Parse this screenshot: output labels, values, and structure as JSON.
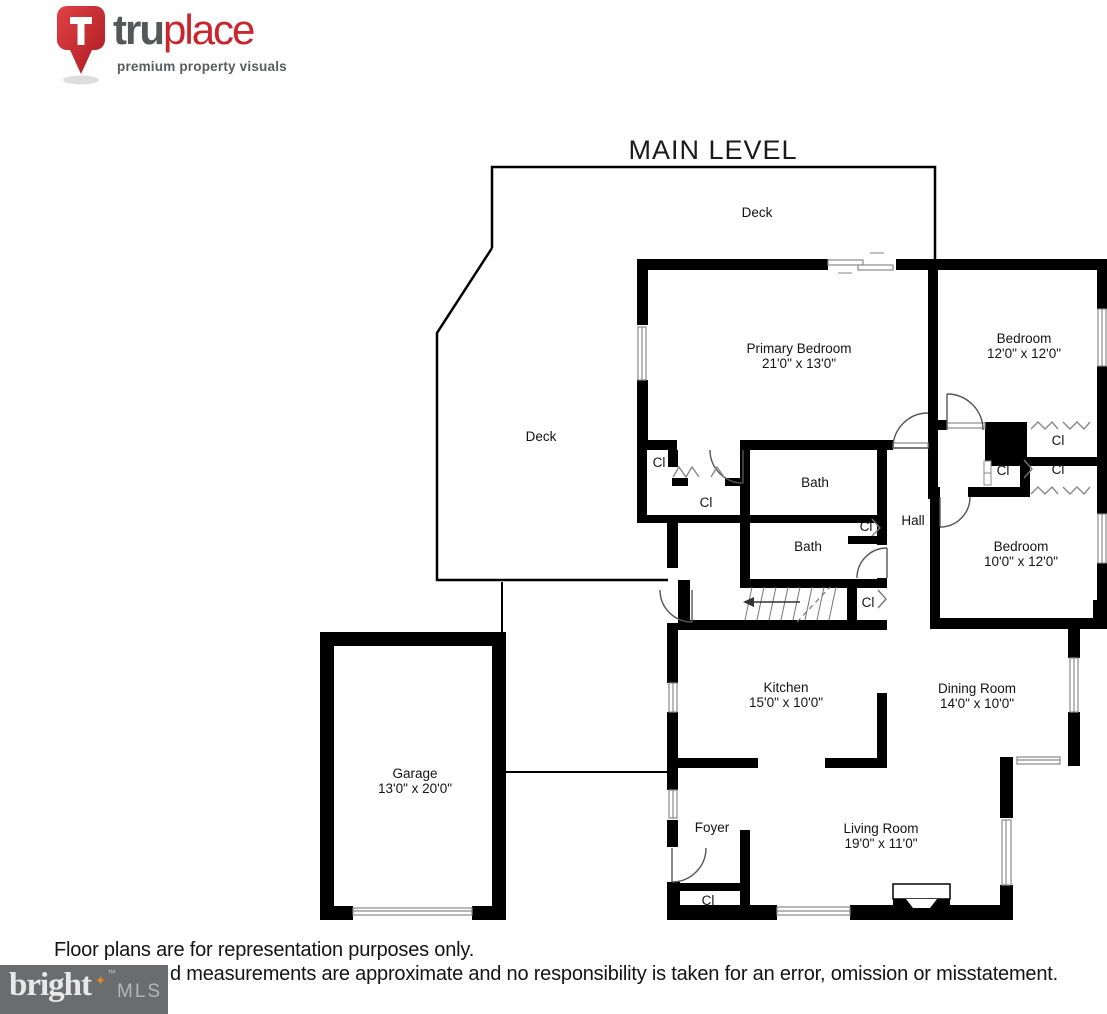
{
  "header": {
    "brand_prefix": "tru",
    "brand_suffix": "place",
    "tagline": "premium property visuals"
  },
  "title": "MAIN LEVEL",
  "plan": {
    "closet_label": "Cl",
    "rooms": [
      {
        "id": "deck-top",
        "name": "Deck",
        "dims": ""
      },
      {
        "id": "deck-left",
        "name": "Deck",
        "dims": ""
      },
      {
        "id": "primary-bedroom",
        "name": "Primary Bedroom",
        "dims": "21'0\" x 13'0\""
      },
      {
        "id": "bedroom-1",
        "name": "Bedroom",
        "dims": "12'0\" x 12'0\""
      },
      {
        "id": "bedroom-2",
        "name": "Bedroom",
        "dims": "10'0\" x 12'0\""
      },
      {
        "id": "bath-1",
        "name": "Bath",
        "dims": ""
      },
      {
        "id": "bath-2",
        "name": "Bath",
        "dims": ""
      },
      {
        "id": "hall",
        "name": "Hall",
        "dims": ""
      },
      {
        "id": "kitchen",
        "name": "Kitchen",
        "dims": "15'0\" x 10'0\""
      },
      {
        "id": "dining-room",
        "name": "Dining Room",
        "dims": "14'0\" x 10'0\""
      },
      {
        "id": "garage",
        "name": "Garage",
        "dims": "13'0\" x 20'0\""
      },
      {
        "id": "foyer",
        "name": "Foyer",
        "dims": ""
      },
      {
        "id": "living-room",
        "name": "Living Room",
        "dims": "19'0\" x 11'0\""
      }
    ]
  },
  "footer": {
    "line1": "Floor plans are for representation purposes only.",
    "line2": "d measurements are approximate and no responsibility is taken for an error, omission or misstatement.",
    "mls_brand": "bright",
    "mls_star": "✦",
    "mls_tm": "™",
    "mls_suffix": "MLS"
  },
  "colors": {
    "brand_red": "#c9252c",
    "brand_gray": "#565759",
    "wall_black": "#000000",
    "window_gray": "#8a8a8a",
    "mls_bg": "#6b6c6e",
    "mls_star_orange": "#e8872c"
  }
}
